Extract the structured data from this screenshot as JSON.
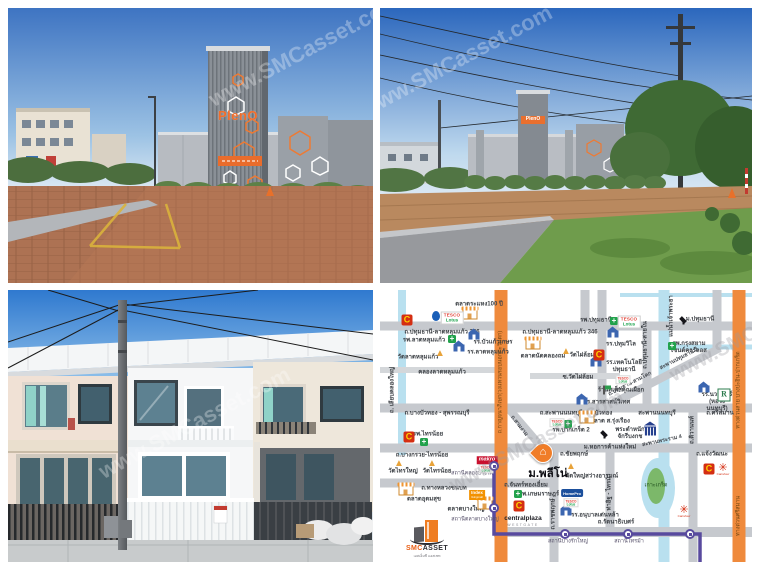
{
  "watermark": "www.SMCasset.com",
  "photos": {
    "sign_brand": "PlenO"
  },
  "branding": {
    "name_left": "SMC",
    "name_right": "ASSET",
    "tagline": "เอสเอ็มซี แอสเซท"
  },
  "colors": {
    "accent_orange": "#f07d2a",
    "transit_purple": "#584a9e",
    "road_gray": "#c6c9ce",
    "water_blue": "#b9e0ef",
    "brand_red": "#e03c31",
    "lotus_green": "#1aa24a"
  },
  "map": {
    "brands": {
      "tesco": "TESCO",
      "lotus": "Lotus",
      "makro": "makro",
      "central_c": "C",
      "carrefour": "Carrefour",
      "homepro": "HomePro",
      "index": "Index",
      "index_sub": "livingmall",
      "centralplaza": "centralplaza",
      "westgate": "WESTGATE",
      "robinson": "R"
    },
    "items": [
      {
        "n": "road-label-346-west",
        "t": "h",
        "s": "ถ.ปทุมธานี-ลาดหลุมแก้ว 346",
        "x": 62,
        "y": 43
      },
      {
        "n": "road-label-346-east",
        "t": "h",
        "s": "ถ.ปทุมธานี-ลาดหลุมแก้ว 346",
        "x": 180,
        "y": 43
      },
      {
        "n": "canal-label-latlumkaeo",
        "t": "h",
        "s": "คลองลาดหลุมแก้ว",
        "x": 62,
        "y": 83
      },
      {
        "n": "road-label-bangbuathong-suphanburi",
        "t": "h",
        "s": "ถ.บางบัวทอง - สุพรรณบุรี",
        "x": 57,
        "y": 124
      },
      {
        "n": "road-label-saphan-nonthaburi-bangbuathong",
        "t": "h",
        "s": "ถ.สะพานนนทบุรี-บางบัวทอง",
        "x": 196,
        "y": 124
      },
      {
        "n": "road-label-srisaman",
        "t": "h",
        "s": "ถ.ศรีสมาน",
        "x": 340,
        "y": 124
      },
      {
        "n": "road-label-bangkruai-sainoi",
        "t": "h",
        "s": "ถ.บางกรวย-ไทรน้อย",
        "x": 42,
        "y": 166
      },
      {
        "n": "road-label-chaiyapruek",
        "t": "h",
        "s": "ถ.ชัยพฤกษ์",
        "x": 194,
        "y": 165
      },
      {
        "n": "road-label-chaengwattana",
        "t": "h",
        "s": "ถ.แจ้งวัฒนะ",
        "x": 332,
        "y": 165
      },
      {
        "n": "road-label-thangluang-chonnabot",
        "t": "h",
        "s": "ถ.ทางหลวงชนบท",
        "x": 64,
        "y": 199
      },
      {
        "n": "road-label-chanthong-iam",
        "t": "h",
        "s": "ถ.จันทร์ทองเอี่ยม",
        "x": 146,
        "y": 196
      },
      {
        "n": "road-label-rattanathibet",
        "t": "h",
        "s": "ถ.รัตนาธิเบศร์",
        "x": 236,
        "y": 233
      },
      {
        "n": "bridge-label-nonthaburi",
        "t": "h",
        "s": "สะพานนนทบุรี",
        "x": 277,
        "y": 124
      },
      {
        "n": "soi-label-watphailom",
        "t": "h",
        "s": "ซ.วัดไผ่ล้อม",
        "x": 198,
        "y": 88
      },
      {
        "n": "station-label-khlongbangphai",
        "t": "h",
        "c": "st",
        "s": "สถานีคลองบางไผ่",
        "x": 92,
        "y": 184
      },
      {
        "n": "station-label-talatbangyai",
        "t": "h",
        "c": "st",
        "s": "สถานีตลาดบางใหญ่",
        "x": 95,
        "y": 230
      },
      {
        "n": "station-label-bangrakyai",
        "t": "h",
        "c": "st",
        "s": "สถานีบางรักใหญ่",
        "x": 188,
        "y": 252
      },
      {
        "n": "station-label-saima",
        "t": "h",
        "c": "st",
        "s": "สถานีไทรม้า",
        "x": 249,
        "y": 252
      },
      {
        "n": "market-label-rahaeng",
        "t": "h",
        "s": "ตลาดระแหง100 ปี",
        "x": 99,
        "y": 15
      },
      {
        "n": "market-label-natkhlongthom",
        "t": "h",
        "s": "ตลาดนัดคลองถม",
        "x": 163,
        "y": 67
      },
      {
        "n": "market-label-udomsuk",
        "t": "h",
        "s": "ตลาดอุดมสุข",
        "x": 44,
        "y": 210
      },
      {
        "n": "market-label-bangyai",
        "t": "h",
        "s": "ตลาดบางใหญ่",
        "x": 86,
        "y": 220
      },
      {
        "n": "market-label-so-rungrueang",
        "t": "h",
        "s": "ตลาด ส.รุ่งเรือง",
        "x": 230,
        "y": 132
      },
      {
        "n": "island-label-kohkret",
        "t": "h",
        "c": "isl",
        "s": "เกาะเกร็ด",
        "x": 276,
        "y": 196
      },
      {
        "n": "hospital-label-latlumkaeo",
        "t": "h",
        "s": "รพ.ลาดหลุมแก้ว",
        "x": 44,
        "y": 51
      },
      {
        "n": "temple-label-latlumkaeo",
        "t": "h",
        "s": "วัดลาดหลุมแก้ว",
        "x": 38,
        "y": 68
      },
      {
        "n": "school-label-buakaewkesorn",
        "t": "h",
        "s": "รร.บัวแก้วเกษร",
        "x": 113,
        "y": 53
      },
      {
        "n": "school-label-latlumkaeo",
        "t": "h",
        "s": "รร.ลาดหลุมแก้ว",
        "x": 108,
        "y": 63
      },
      {
        "n": "temple-label-watphailom",
        "t": "h",
        "s": "วัดไผ่ล้อม",
        "x": 202,
        "y": 66
      },
      {
        "n": "hospital-label-pathumthani",
        "t": "h",
        "s": "รพ.ปทุมธานี",
        "x": 216,
        "y": 31
      },
      {
        "n": "school-label-pathumwilai",
        "t": "h",
        "s": "รร.ปทุมวิไล",
        "x": 241,
        "y": 55
      },
      {
        "n": "university-label-pathumthani",
        "t": "h",
        "s": "ม.ปทุมธานี",
        "x": 320,
        "y": 30
      },
      {
        "n": "hospital-label-krungsiam",
        "t": "h",
        "s": "รพ.กรุงสยาม\nเซนต์คาร์ลอส",
        "x": 309,
        "y": 58
      },
      {
        "n": "school-label-technology-pathumthani",
        "t": "h",
        "s": "รร.เทคโนโลยี\nปทุมธานี",
        "x": 244,
        "y": 77
      },
      {
        "n": "restaurant-label-steak",
        "t": "h",
        "s": "ร้านสเต็กคุณเผือก",
        "x": 241,
        "y": 101
      },
      {
        "n": "school-label-sarasas",
        "t": "h",
        "s": "รร.สารสาสน์วิเทศ",
        "x": 227,
        "y": 113
      },
      {
        "n": "hospital-label-pakkret2",
        "t": "h",
        "s": "รพ.ปากเกร็ด 2",
        "x": 191,
        "y": 141
      },
      {
        "n": "university-label-utcc",
        "t": "h",
        "s": "ม.หอการค้าแห่งใหม่",
        "x": 230,
        "y": 158
      },
      {
        "n": "palace-label-chakribongkot",
        "t": "h",
        "s": "พระตำหนัก\nจักรีบงกช",
        "x": 250,
        "y": 144
      },
      {
        "n": "school-label-nawamin",
        "t": "h",
        "s": "รร.นวมินทร์\n(หอวัง นนทบุรี)",
        "x": 337,
        "y": 113
      },
      {
        "n": "hospital-label-sainoi",
        "t": "h",
        "s": "รพ.ไทรน้อย",
        "x": 48,
        "y": 145
      },
      {
        "n": "temple-label-saiyai",
        "t": "h",
        "s": "วัดไทรใหญ่",
        "x": 23,
        "y": 182
      },
      {
        "n": "temple-label-sainoi",
        "t": "h",
        "s": "วัดไทรน้อย",
        "x": 57,
        "y": 182
      },
      {
        "n": "temple-label-watyai-sawangarom",
        "t": "h",
        "s": "วัดใหญ่สว่างอารมณ์",
        "x": 212,
        "y": 187
      },
      {
        "n": "hospital-label-kasemrad",
        "t": "h",
        "s": "รพ.เกษมราษฎร์",
        "x": 159,
        "y": 205
      },
      {
        "n": "school-label-denla",
        "t": "h",
        "s": "รร.อนุบาลเด่นหล้า",
        "x": 215,
        "y": 226
      },
      {
        "n": "road-label-liapkhlongyai",
        "t": "v",
        "s": "ถ. เลียบคลองใหญ่",
        "x": 13,
        "y": 100
      },
      {
        "n": "road-label-kanchanaphisek",
        "t": "v",
        "c": "onorange",
        "s": "ถ.กาญจนาภิเษก(วงแหวนรอบนอกตะวันตก)",
        "x": 121,
        "y": 92
      },
      {
        "n": "river-label-chaophraya",
        "t": "v",
        "s": "แม่น้ำเจ้าพระยา",
        "x": 292,
        "y": 26
      },
      {
        "n": "road-label-pathumthani-sainai",
        "t": "v",
        "s": "ถ.ปทุมธานี-สายใน",
        "x": 266,
        "y": 55
      },
      {
        "n": "road-label-tiwanon",
        "t": "v",
        "s": "ถ.ติวานนท์",
        "x": 313,
        "y": 140
      },
      {
        "n": "road-label-ratchaphruek",
        "t": "v",
        "s": "ถ.ราชพฤกษ์",
        "x": 174,
        "y": 224
      },
      {
        "n": "road-label-thait-saima",
        "t": "v",
        "s": "ท่าอิฐ - ไทรม้า",
        "x": 230,
        "y": 202
      },
      {
        "n": "expressway-label-bangpain-pakkret",
        "t": "v",
        "c": "onorange",
        "s": "ทางด่วนสาย บางปะอิน-ปากเกร็ด",
        "x": 359,
        "y": 100
      },
      {
        "n": "expressway-label-srisaman",
        "t": "v",
        "c": "onorange",
        "s": "ทางด่วนศรีสมาน",
        "x": 359,
        "y": 226
      },
      {
        "n": "road-label-pathumthani-samkhok",
        "t": "d",
        "r": -27,
        "s": "ถ.ปทุมธานี-สามโคก",
        "x": 250,
        "y": 94
      },
      {
        "n": "bridge-label-pathumthani2",
        "t": "d",
        "r": -27,
        "s": "สะพานปทุมธานี 2",
        "x": 299,
        "y": 69
      },
      {
        "n": "bridge-label-rama4",
        "t": "d",
        "r": -12,
        "s": "สะพานพระราม 4",
        "x": 282,
        "y": 151
      },
      {
        "n": "road-label-samngam",
        "t": "d",
        "r": 52,
        "s": "ถ.สามงาม",
        "x": 139,
        "y": 136
      },
      {
        "n": "hospital-icon",
        "t": "icon",
        "c": "hosp",
        "x": 72,
        "y": 49
      },
      {
        "n": "hospital-icon",
        "t": "icon",
        "c": "hosp",
        "x": 234,
        "y": 31
      },
      {
        "n": "hospital-icon",
        "t": "icon",
        "c": "hosp",
        "x": 292,
        "y": 56
      },
      {
        "n": "hospital-icon",
        "t": "icon",
        "c": "hosp",
        "x": 188,
        "y": 134
      },
      {
        "n": "hospital-icon",
        "t": "icon",
        "c": "hosp",
        "x": 44,
        "y": 152
      },
      {
        "n": "hospital-icon",
        "t": "icon",
        "c": "hosp",
        "x": 138,
        "y": 204
      },
      {
        "n": "temple-icon",
        "t": "icon",
        "c": "temple",
        "x": 60,
        "y": 64
      },
      {
        "n": "temple-icon",
        "t": "icon",
        "c": "temple",
        "x": 186,
        "y": 62
      },
      {
        "n": "temple-icon",
        "t": "icon",
        "c": "temple",
        "x": 19,
        "y": 174
      },
      {
        "n": "temple-icon",
        "t": "icon",
        "c": "temple",
        "x": 52,
        "y": 174
      },
      {
        "n": "temple-icon",
        "t": "icon",
        "c": "temple",
        "x": 191,
        "y": 177
      },
      {
        "n": "school-icon",
        "t": "icon",
        "c": "school",
        "x": 94,
        "y": 46
      },
      {
        "n": "school-icon",
        "t": "icon",
        "c": "school",
        "x": 79,
        "y": 58
      },
      {
        "n": "school-icon",
        "t": "icon",
        "c": "school",
        "x": 233,
        "y": 44
      },
      {
        "n": "school-icon",
        "t": "icon",
        "c": "school",
        "x": 216,
        "y": 73
      },
      {
        "n": "school-icon",
        "t": "icon",
        "c": "school",
        "x": 202,
        "y": 111
      },
      {
        "n": "school-icon",
        "t": "icon",
        "c": "school",
        "x": 324,
        "y": 99
      },
      {
        "n": "school-icon",
        "t": "icon",
        "c": "school",
        "x": 186,
        "y": 222
      },
      {
        "n": "graduation-cap-icon",
        "t": "icon",
        "c": "grad",
        "x": 303,
        "y": 30
      },
      {
        "n": "graduation-cap-icon",
        "t": "icon",
        "c": "grad",
        "x": 224,
        "y": 144
      },
      {
        "n": "bank-icon",
        "t": "icon",
        "c": "bank",
        "x": 270,
        "y": 141
      },
      {
        "n": "market-icon",
        "t": "icon",
        "c": "shop",
        "x": 90,
        "y": 25
      },
      {
        "n": "market-icon",
        "t": "icon",
        "c": "shop",
        "x": 153,
        "y": 55
      },
      {
        "n": "market-icon",
        "t": "icon",
        "c": "shop",
        "x": 26,
        "y": 201
      },
      {
        "n": "market-icon",
        "t": "icon",
        "c": "shop",
        "x": 105,
        "y": 215
      },
      {
        "n": "market-icon",
        "t": "icon",
        "c": "shop",
        "x": 207,
        "y": 129
      },
      {
        "n": "restaurant-icon",
        "t": "icon",
        "c": "flag",
        "x": 224,
        "y": 100
      },
      {
        "n": "gas-station-icon",
        "t": "icon",
        "c": "drop",
        "x": 56,
        "y": 26
      },
      {
        "n": "tesco-lotus-logo",
        "t": "logo",
        "c": "tesco",
        "x": 72,
        "y": 28
      },
      {
        "n": "tesco-lotus-logo",
        "t": "logo",
        "c": "tesco",
        "x": 249,
        "y": 32
      },
      {
        "n": "tesco-lotus-mini-logo",
        "t": "logo",
        "c": "tescomini",
        "x": 243,
        "y": 90
      },
      {
        "n": "tesco-lotus-mini-logo",
        "t": "logo",
        "c": "tescomini",
        "x": 177,
        "y": 133
      },
      {
        "n": "tesco-lotus-mini-logo",
        "t": "logo",
        "c": "tescomini",
        "x": 106,
        "y": 179
      },
      {
        "n": "tesco-lotus-mini-logo",
        "t": "logo",
        "c": "tescomini",
        "x": 191,
        "y": 213
      },
      {
        "n": "makro-logo",
        "t": "logo",
        "c": "makro",
        "x": 107,
        "y": 170
      },
      {
        "n": "central-c-logo",
        "t": "logo",
        "c": "central",
        "x": 27,
        "y": 30
      },
      {
        "n": "central-c-logo",
        "t": "logo",
        "c": "central",
        "x": 219,
        "y": 65
      },
      {
        "n": "central-c-logo",
        "t": "logo",
        "c": "central",
        "x": 29,
        "y": 147
      },
      {
        "n": "central-c-logo",
        "t": "logo",
        "c": "central",
        "x": 139,
        "y": 216
      },
      {
        "n": "central-c-logo",
        "t": "logo",
        "c": "central",
        "x": 329,
        "y": 179
      },
      {
        "n": "carrefour-logo",
        "t": "logo",
        "c": "carrefour",
        "x": 343,
        "y": 180
      },
      {
        "n": "carrefour-logo",
        "t": "logo",
        "c": "carrefour",
        "x": 304,
        "y": 222
      },
      {
        "n": "homepro-logo",
        "t": "logo",
        "c": "homepro",
        "x": 192,
        "y": 203
      },
      {
        "n": "index-logo",
        "t": "logo",
        "c": "index",
        "x": 97,
        "y": 205
      },
      {
        "n": "centralplaza-westgate-logo",
        "t": "logo",
        "c": "cpw",
        "x": 143,
        "y": 231
      },
      {
        "n": "robinson-logo",
        "t": "logo",
        "c": "robinson",
        "x": 344,
        "y": 105
      },
      {
        "n": "mrt-station",
        "t": "st",
        "x": 114,
        "y": 176
      },
      {
        "n": "mrt-station",
        "t": "st",
        "x": 114,
        "y": 218
      },
      {
        "n": "mrt-station",
        "t": "st",
        "x": 185,
        "y": 244
      },
      {
        "n": "mrt-station",
        "t": "st",
        "x": 248,
        "y": 244
      },
      {
        "n": "mrt-station",
        "t": "st",
        "x": 310,
        "y": 244
      },
      {
        "n": "property-pin",
        "t": "pin",
        "x": 163,
        "y": 173
      },
      {
        "n": "property-label-pleno",
        "t": "big",
        "s": "ม.พลีโน่",
        "x": 168,
        "y": 184
      }
    ]
  }
}
